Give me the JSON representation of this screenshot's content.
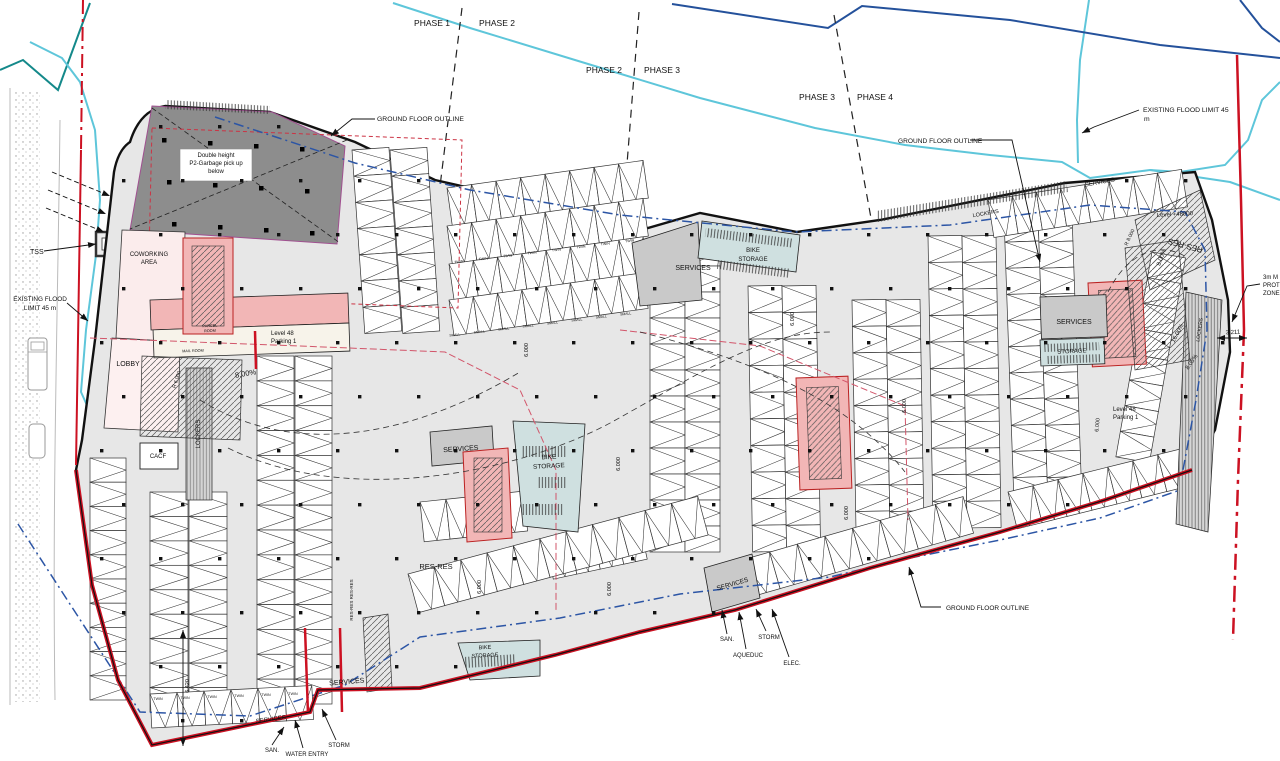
{
  "meta": {
    "drawing_kind": "parking level floor plan",
    "level_label": "Level 48",
    "parking_label": "Parking 1"
  },
  "colors": {
    "flood_cyan": "#5ec6da",
    "navy": "#24519b",
    "teal": "#14898a",
    "boundary_red": "#cc1122",
    "interior_red_dash": "#d2556a",
    "blue_dash": "#2c55a5",
    "floor_gray": "#e7e7e7",
    "services_gray": "#c9c9c9",
    "garbage_gray": "#8d8d8d",
    "core_pink": "#f2b6b6",
    "lobby_pink": "#fbecec",
    "bike_blue": "#cfe0e0"
  },
  "annotations": [
    {
      "n": "phase-1-label",
      "t": "PHASE 1",
      "x": 432,
      "y": 26,
      "s": 8.5
    },
    {
      "n": "phase-2-label",
      "t": "PHASE 2",
      "x": 497,
      "y": 26,
      "s": 8.5
    },
    {
      "n": "phase-2b-label",
      "t": "PHASE 2",
      "x": 604,
      "y": 73,
      "s": 8.5
    },
    {
      "n": "phase-3-label",
      "t": "PHASE 3",
      "x": 662,
      "y": 73,
      "s": 8.5
    },
    {
      "n": "phase-3b-label",
      "t": "PHASE 3",
      "x": 817,
      "y": 100,
      "s": 8.5
    },
    {
      "n": "phase-4-label",
      "t": "PHASE 4",
      "x": 875,
      "y": 100,
      "s": 8.5
    },
    {
      "n": "ground-floor-outline-top",
      "t": "GROUND FLOOR OUTLINE",
      "x": 377,
      "y": 121,
      "s": 6.8,
      "a": "s"
    },
    {
      "n": "existing-flood-limit-right-1",
      "t": "EXISTING FLOOD LIMIT 45",
      "x": 1143,
      "y": 112,
      "s": 6.8,
      "a": "s"
    },
    {
      "n": "existing-flood-limit-right-2",
      "t": "m",
      "x": 1144,
      "y": 121,
      "s": 6.8,
      "a": "s"
    },
    {
      "n": "ground-floor-outline-right",
      "t": "GROUND FLOOR OUTLINE",
      "x": 898,
      "y": 143,
      "s": 6.6,
      "a": "s"
    },
    {
      "n": "garbage-note-1",
      "t": "Double height",
      "x": 216,
      "y": 157,
      "s": 6
    },
    {
      "n": "garbage-note-2",
      "t": "P2-Garbage pick up",
      "x": 216,
      "y": 165,
      "s": 6
    },
    {
      "n": "garbage-note-3",
      "t": "below",
      "x": 216,
      "y": 173,
      "s": 6
    },
    {
      "n": "tss-label",
      "t": "TSS",
      "x": 30,
      "y": 254,
      "s": 7,
      "a": "s"
    },
    {
      "n": "existing-flood-limit-left-1",
      "t": "EXISTING FLOOD",
      "x": 40,
      "y": 301,
      "s": 6.4
    },
    {
      "n": "existing-flood-limit-left-2",
      "t": "LIMIT 45 m",
      "x": 40,
      "y": 310,
      "s": 6.4
    },
    {
      "n": "coworking-label-1",
      "t": "COWORKING",
      "x": 149,
      "y": 256,
      "s": 6
    },
    {
      "n": "coworking-label-2",
      "t": "AREA",
      "x": 149,
      "y": 264,
      "s": 6
    },
    {
      "n": "lobby-label",
      "t": "LOBBY",
      "x": 128,
      "y": 366,
      "s": 7
    },
    {
      "n": "level48-left-1",
      "t": "Level 48",
      "x": 271,
      "y": 335,
      "s": 6,
      "a": "s"
    },
    {
      "n": "level48-left-2",
      "t": "Parking 1",
      "x": 271,
      "y": 343,
      "s": 6,
      "a": "s"
    },
    {
      "n": "ramp-slope-left",
      "t": "8.00%",
      "x": 246,
      "y": 376,
      "r": -10,
      "s": 7.5
    },
    {
      "n": "cacf-label",
      "t": "CACF",
      "x": 158,
      "y": 458,
      "s": 6
    },
    {
      "n": "lockers-label-left",
      "t": "LOCKERS",
      "x": 200,
      "y": 434,
      "r": -90,
      "s": 6
    },
    {
      "n": "parcel-room-1",
      "t": "PARCEL",
      "x": 210,
      "y": 327,
      "r": -3,
      "s": 3.8
    },
    {
      "n": "parcel-room-2",
      "t": "ROOM",
      "x": 210,
      "y": 332,
      "r": -3,
      "s": 3.8
    },
    {
      "n": "mail-room",
      "t": "MAIL ROOM",
      "x": 193,
      "y": 352,
      "r": -2,
      "s": 3.8
    },
    {
      "n": "ramp-radius-left",
      "t": "R 6.000",
      "x": 178,
      "y": 380,
      "r": -72,
      "s": 5
    },
    {
      "n": "services-center",
      "t": "SERVICES",
      "x": 461,
      "y": 451,
      "r": -4,
      "s": 7
    },
    {
      "n": "bike-storage-center-1",
      "t": "BIKE",
      "x": 549,
      "y": 459,
      "r": -3,
      "s": 6.5
    },
    {
      "n": "bike-storage-center-2",
      "t": "STORAGE",
      "x": 549,
      "y": 468,
      "r": -3,
      "s": 6.5
    },
    {
      "n": "res-res-center",
      "t": "RES-RES",
      "x": 436,
      "y": 569,
      "s": 7.5
    },
    {
      "n": "res-res-vertical",
      "t": "RES-RES RES-RES",
      "x": 353,
      "y": 600,
      "r": -90,
      "s": 4.5
    },
    {
      "n": "services-topmid",
      "t": "SERVICES",
      "x": 693,
      "y": 270,
      "s": 7
    },
    {
      "n": "bike-storage-top-1",
      "t": "BIKE",
      "x": 753,
      "y": 252,
      "s": 6
    },
    {
      "n": "bike-storage-top-2",
      "t": "STORAGE",
      "x": 753,
      "y": 261,
      "s": 6
    },
    {
      "n": "dim-6000-1",
      "t": "6.000",
      "x": 528,
      "y": 350,
      "r": -90,
      "s": 5.5
    },
    {
      "n": "dim-6000-2",
      "t": "6.000",
      "x": 620,
      "y": 464,
      "r": -90,
      "s": 5.5
    },
    {
      "n": "dim-6000-3",
      "t": "6.000",
      "x": 481,
      "y": 587,
      "r": -90,
      "s": 5.5
    },
    {
      "n": "dim-6000-4",
      "t": "6.000",
      "x": 611,
      "y": 589,
      "r": -90,
      "s": 5.5
    },
    {
      "n": "dim-6000-5",
      "t": "6.000",
      "x": 794,
      "y": 319,
      "r": -90,
      "s": 5.5
    },
    {
      "n": "dim-6000-6",
      "t": "6.000",
      "x": 906,
      "y": 406,
      "r": -90,
      "s": 5.5
    },
    {
      "n": "dim-6000-7",
      "t": "6.000",
      "x": 848,
      "y": 513,
      "r": -90,
      "s": 5.5
    },
    {
      "n": "dim-6000-8",
      "t": "6.000",
      "x": 1099,
      "y": 425,
      "r": -85,
      "s": 5.5
    },
    {
      "n": "dim-6420",
      "t": "6.420",
      "x": 189,
      "y": 686,
      "r": -90,
      "s": 5.5
    },
    {
      "n": "services-botmid",
      "t": "SERVICES",
      "x": 733,
      "y": 586,
      "r": -16,
      "s": 6.5
    },
    {
      "n": "san-mid",
      "t": "SAN.",
      "x": 727,
      "y": 641,
      "s": 6
    },
    {
      "n": "aqueduc-mid",
      "t": "AQUEDUC",
      "x": 748,
      "y": 657,
      "s": 6
    },
    {
      "n": "storm-mid",
      "t": "STORM",
      "x": 769,
      "y": 639,
      "s": 6
    },
    {
      "n": "elec-mid",
      "t": "ELEC.",
      "x": 792,
      "y": 665,
      "s": 6
    },
    {
      "n": "ground-floor-outline-bottom",
      "t": "GROUND FLOOR OUTLINE",
      "x": 946,
      "y": 610,
      "s": 6.5,
      "a": "s"
    },
    {
      "n": "services-botleft",
      "t": "SERVICES",
      "x": 347,
      "y": 684,
      "r": -5,
      "s": 7
    },
    {
      "n": "services-botleft-2",
      "t": "SERVICES",
      "x": 271,
      "y": 721,
      "r": -8,
      "s": 6
    },
    {
      "n": "san-botleft",
      "t": "SAN.",
      "x": 272,
      "y": 752,
      "s": 6
    },
    {
      "n": "water-entry",
      "t": "WATER ENTRY",
      "x": 307,
      "y": 756,
      "s": 6
    },
    {
      "n": "storm-botleft",
      "t": "STORM",
      "x": 339,
      "y": 747,
      "s": 6
    },
    {
      "n": "bike-storage-botleft-1",
      "t": "BIKE",
      "x": 485,
      "y": 649,
      "r": -3,
      "s": 5.5
    },
    {
      "n": "bike-storage-botleft-2",
      "t": "STORAGE",
      "x": 485,
      "y": 657,
      "r": -3,
      "s": 5.5
    },
    {
      "n": "services-right",
      "t": "SERVICES",
      "x": 1074,
      "y": 324,
      "s": 7
    },
    {
      "n": "storage-right",
      "t": "STORAGE",
      "x": 1072,
      "y": 353,
      "r": -3,
      "s": 6
    },
    {
      "n": "level48-right-1",
      "t": "Level 48",
      "x": 1113,
      "y": 411,
      "s": 6,
      "a": "s"
    },
    {
      "n": "level48-right-2",
      "t": "Parking 1",
      "x": 1113,
      "y": 419,
      "s": 6,
      "a": "s"
    },
    {
      "n": "level-48000",
      "t": "Level +48000",
      "x": 1175,
      "y": 216,
      "r": -3,
      "s": 6
    },
    {
      "n": "res-res-right",
      "t": "RES-RES",
      "x": 1186,
      "y": 243,
      "r": 195,
      "s": 8
    },
    {
      "n": "ramp-slope-right-a",
      "t": "8.00%",
      "x": 1163,
      "y": 258,
      "r": -70,
      "s": 6
    },
    {
      "n": "ramp-radius-right",
      "t": "R 8.000",
      "x": 1131,
      "y": 238,
      "r": -65,
      "s": 5
    },
    {
      "n": "ramp-slope-right-b",
      "t": "16.00%",
      "x": 1179,
      "y": 334,
      "r": -62,
      "s": 6
    },
    {
      "n": "ramp-slope-right-c",
      "t": "8.05%",
      "x": 1193,
      "y": 363,
      "r": -55,
      "s": 6
    },
    {
      "n": "prot-zone-1",
      "t": "3m M",
      "x": 1263,
      "y": 279,
      "s": 6,
      "a": "s"
    },
    {
      "n": "prot-zone-2",
      "t": "PROT",
      "x": 1263,
      "y": 287,
      "s": 6,
      "a": "s"
    },
    {
      "n": "prot-zone-3",
      "t": "ZONE",
      "x": 1263,
      "y": 295,
      "s": 6,
      "a": "s"
    },
    {
      "n": "dim-3211",
      "t": "3.211",
      "x": 1233,
      "y": 334,
      "r": -3,
      "s": 6
    },
    {
      "n": "services-topright",
      "t": "SERVICES",
      "x": 1100,
      "y": 184,
      "r": -10,
      "s": 6
    },
    {
      "n": "lockers-topright",
      "t": "LOCKERS",
      "x": 986,
      "y": 215,
      "r": -10,
      "s": 5.5
    },
    {
      "n": "lockers-rightedge",
      "t": "LOCKERS",
      "x": 1201,
      "y": 330,
      "r": -82,
      "s": 5
    }
  ],
  "stall_tag_rows": [
    {
      "t": "TWIN",
      "x0": 459,
      "y0": 263,
      "dx": 24.4,
      "dy": -3,
      "n": 8,
      "s": 3.6,
      "r": -7
    },
    {
      "t": "SMALL",
      "x0": 455,
      "y0": 336,
      "dx": 24.4,
      "dy": -3,
      "n": 8,
      "s": 3.4,
      "r": -7
    },
    {
      "t": "TWIN",
      "x0": 158,
      "y0": 700,
      "dx": 27,
      "dy": -1,
      "n": 6,
      "s": 3.6,
      "r": 0
    }
  ],
  "parking_rows": [
    {
      "x": 90,
      "y": 458,
      "w": 36,
      "h": 242,
      "axis": "v",
      "n": 10
    },
    {
      "x": 150,
      "y": 492,
      "w": 38,
      "h": 220,
      "axis": "v",
      "n": 9
    },
    {
      "x": 189,
      "y": 492,
      "w": 38,
      "h": 220,
      "axis": "v",
      "n": 9
    },
    {
      "x": 257,
      "y": 356,
      "w": 37,
      "h": 348,
      "axis": "v",
      "n": 14
    },
    {
      "x": 295,
      "y": 356,
      "w": 37,
      "h": 348,
      "axis": "v",
      "n": 14
    },
    {
      "x": 150,
      "y": 694,
      "w": 162,
      "h": 34,
      "axis": "h",
      "n": 6,
      "r": -3
    },
    {
      "x": 352,
      "y": 150,
      "w": 37,
      "h": 184,
      "axis": "v",
      "n": 7,
      "r": -4
    },
    {
      "x": 390,
      "y": 150,
      "w": 37,
      "h": 184,
      "axis": "v",
      "n": 7,
      "r": -4
    },
    {
      "x": 447,
      "y": 188,
      "w": 198,
      "h": 38,
      "axis": "h",
      "n": 8,
      "r": -8
    },
    {
      "x": 447,
      "y": 226,
      "w": 198,
      "h": 38,
      "axis": "h",
      "n": 8,
      "r": -8
    },
    {
      "x": 449,
      "y": 264,
      "w": 196,
      "h": 36,
      "axis": "h",
      "n": 8,
      "r": -8
    },
    {
      "x": 449,
      "y": 300,
      "w": 196,
      "h": 36,
      "axis": "h",
      "n": 8,
      "r": -8
    },
    {
      "x": 420,
      "y": 502,
      "w": 104,
      "h": 40,
      "axis": "h",
      "n": 4,
      "r": -6
    },
    {
      "x": 545,
      "y": 540,
      "w": 96,
      "h": 40,
      "axis": "h",
      "n": 4,
      "r": -12
    },
    {
      "x": 650,
      "y": 240,
      "w": 35,
      "h": 312,
      "axis": "v",
      "n": 12
    },
    {
      "x": 685,
      "y": 240,
      "w": 35,
      "h": 312,
      "axis": "v",
      "n": 12
    },
    {
      "x": 748,
      "y": 286,
      "w": 34,
      "h": 266,
      "axis": "v",
      "n": 10,
      "r": -1
    },
    {
      "x": 782,
      "y": 286,
      "w": 34,
      "h": 266,
      "axis": "v",
      "n": 10,
      "r": -1
    },
    {
      "x": 852,
      "y": 300,
      "w": 34,
      "h": 238,
      "axis": "v",
      "n": 9,
      "r": -1
    },
    {
      "x": 886,
      "y": 300,
      "w": 34,
      "h": 238,
      "axis": "v",
      "n": 9,
      "r": -1
    },
    {
      "x": 928,
      "y": 236,
      "w": 34,
      "h": 292,
      "axis": "v",
      "n": 11,
      "r": -1
    },
    {
      "x": 962,
      "y": 236,
      "w": 34,
      "h": 292,
      "axis": "v",
      "n": 11,
      "r": -1
    },
    {
      "x": 1004,
      "y": 216,
      "w": 34,
      "h": 288,
      "axis": "v",
      "n": 11,
      "r": -2
    },
    {
      "x": 1038,
      "y": 216,
      "w": 34,
      "h": 288,
      "axis": "v",
      "n": 11,
      "r": -2
    },
    {
      "x": 988,
      "y": 200,
      "w": 196,
      "h": 38,
      "axis": "h",
      "n": 8,
      "r": -9
    },
    {
      "x": 1152,
      "y": 252,
      "w": 34,
      "h": 208,
      "axis": "v",
      "n": 8,
      "r": 10
    },
    {
      "x": 408,
      "y": 574,
      "w": 300,
      "h": 40,
      "axis": "h",
      "n": 11,
      "r": -15
    },
    {
      "x": 742,
      "y": 560,
      "w": 230,
      "h": 38,
      "axis": "h",
      "n": 8,
      "r": -16
    },
    {
      "x": 1008,
      "y": 492,
      "w": 180,
      "h": 38,
      "axis": "h",
      "n": 7,
      "r": -14
    }
  ],
  "leaders": [
    {
      "n": "leader-ground-floor-outline-top",
      "p": [
        [
          375,
          119
        ],
        [
          352,
          119
        ],
        [
          331,
          136
        ]
      ],
      "arrow": true
    },
    {
      "n": "leader-existing-flood-right",
      "p": [
        [
          1139,
          110
        ],
        [
          1094,
          127
        ],
        [
          1082,
          133
        ]
      ],
      "arrow": true
    },
    {
      "n": "leader-ground-floor-outline-right",
      "p": [
        [
          970,
          140
        ],
        [
          1012,
          140
        ],
        [
          1040,
          262
        ]
      ],
      "arrow": true
    },
    {
      "n": "leader-tss",
      "p": [
        [
          44,
          251
        ],
        [
          96,
          244
        ]
      ],
      "arrow": true
    },
    {
      "n": "leader-existing-flood-left",
      "p": [
        [
          67,
          303
        ],
        [
          88,
          321
        ]
      ],
      "arrow": true
    },
    {
      "n": "leader-prot-zone",
      "p": [
        [
          1260,
          284
        ],
        [
          1247,
          286
        ],
        [
          1232,
          322
        ]
      ],
      "arrow": true
    },
    {
      "n": "leader-ground-floor-outline-bottom",
      "p": [
        [
          941,
          607
        ],
        [
          921,
          607
        ],
        [
          909,
          567
        ]
      ],
      "arrow": true
    },
    {
      "n": "leader-san-mid",
      "p": [
        [
          727,
          634
        ],
        [
          722,
          610
        ]
      ],
      "arrow": true
    },
    {
      "n": "leader-aqueduc",
      "p": [
        [
          746,
          649
        ],
        [
          739,
          612
        ]
      ],
      "arrow": true
    },
    {
      "n": "leader-storm-mid",
      "p": [
        [
          766,
          631
        ],
        [
          756,
          609
        ]
      ],
      "arrow": true
    },
    {
      "n": "leader-elec",
      "p": [
        [
          789,
          657
        ],
        [
          772,
          609
        ]
      ],
      "arrow": true
    },
    {
      "n": "leader-san-botleft",
      "p": [
        [
          272,
          745
        ],
        [
          284,
          727
        ]
      ],
      "arrow": true
    },
    {
      "n": "leader-water-entry",
      "p": [
        [
          303,
          748
        ],
        [
          295,
          720
        ]
      ],
      "arrow": true
    },
    {
      "n": "leader-storm-botleft",
      "p": [
        [
          336,
          740
        ],
        [
          322,
          709
        ]
      ],
      "arrow": true
    },
    {
      "n": "road-arrow-1",
      "p": [
        [
          52,
          172
        ],
        [
          110,
          196
        ]
      ],
      "arrow": true,
      "dash": true
    },
    {
      "n": "road-arrow-2",
      "p": [
        [
          48,
          190
        ],
        [
          106,
          214
        ]
      ],
      "arrow": true,
      "dash": true
    },
    {
      "n": "road-arrow-3",
      "p": [
        [
          46,
          208
        ],
        [
          104,
          232
        ]
      ],
      "arrow": true,
      "dash": true
    }
  ],
  "dimension_lines": [
    {
      "n": "dimline-6420",
      "p": [
        [
          183,
          630
        ],
        [
          183,
          746
        ]
      ]
    },
    {
      "n": "dimline-3211",
      "p": [
        [
          1217,
          338
        ],
        [
          1247,
          338
        ]
      ]
    }
  ],
  "columns_grid": {
    "x0": 100,
    "y0": 125,
    "dx": 59,
    "dy": 54,
    "cols": 20,
    "rows": 12,
    "size": 3.4,
    "stagger": 22
  }
}
